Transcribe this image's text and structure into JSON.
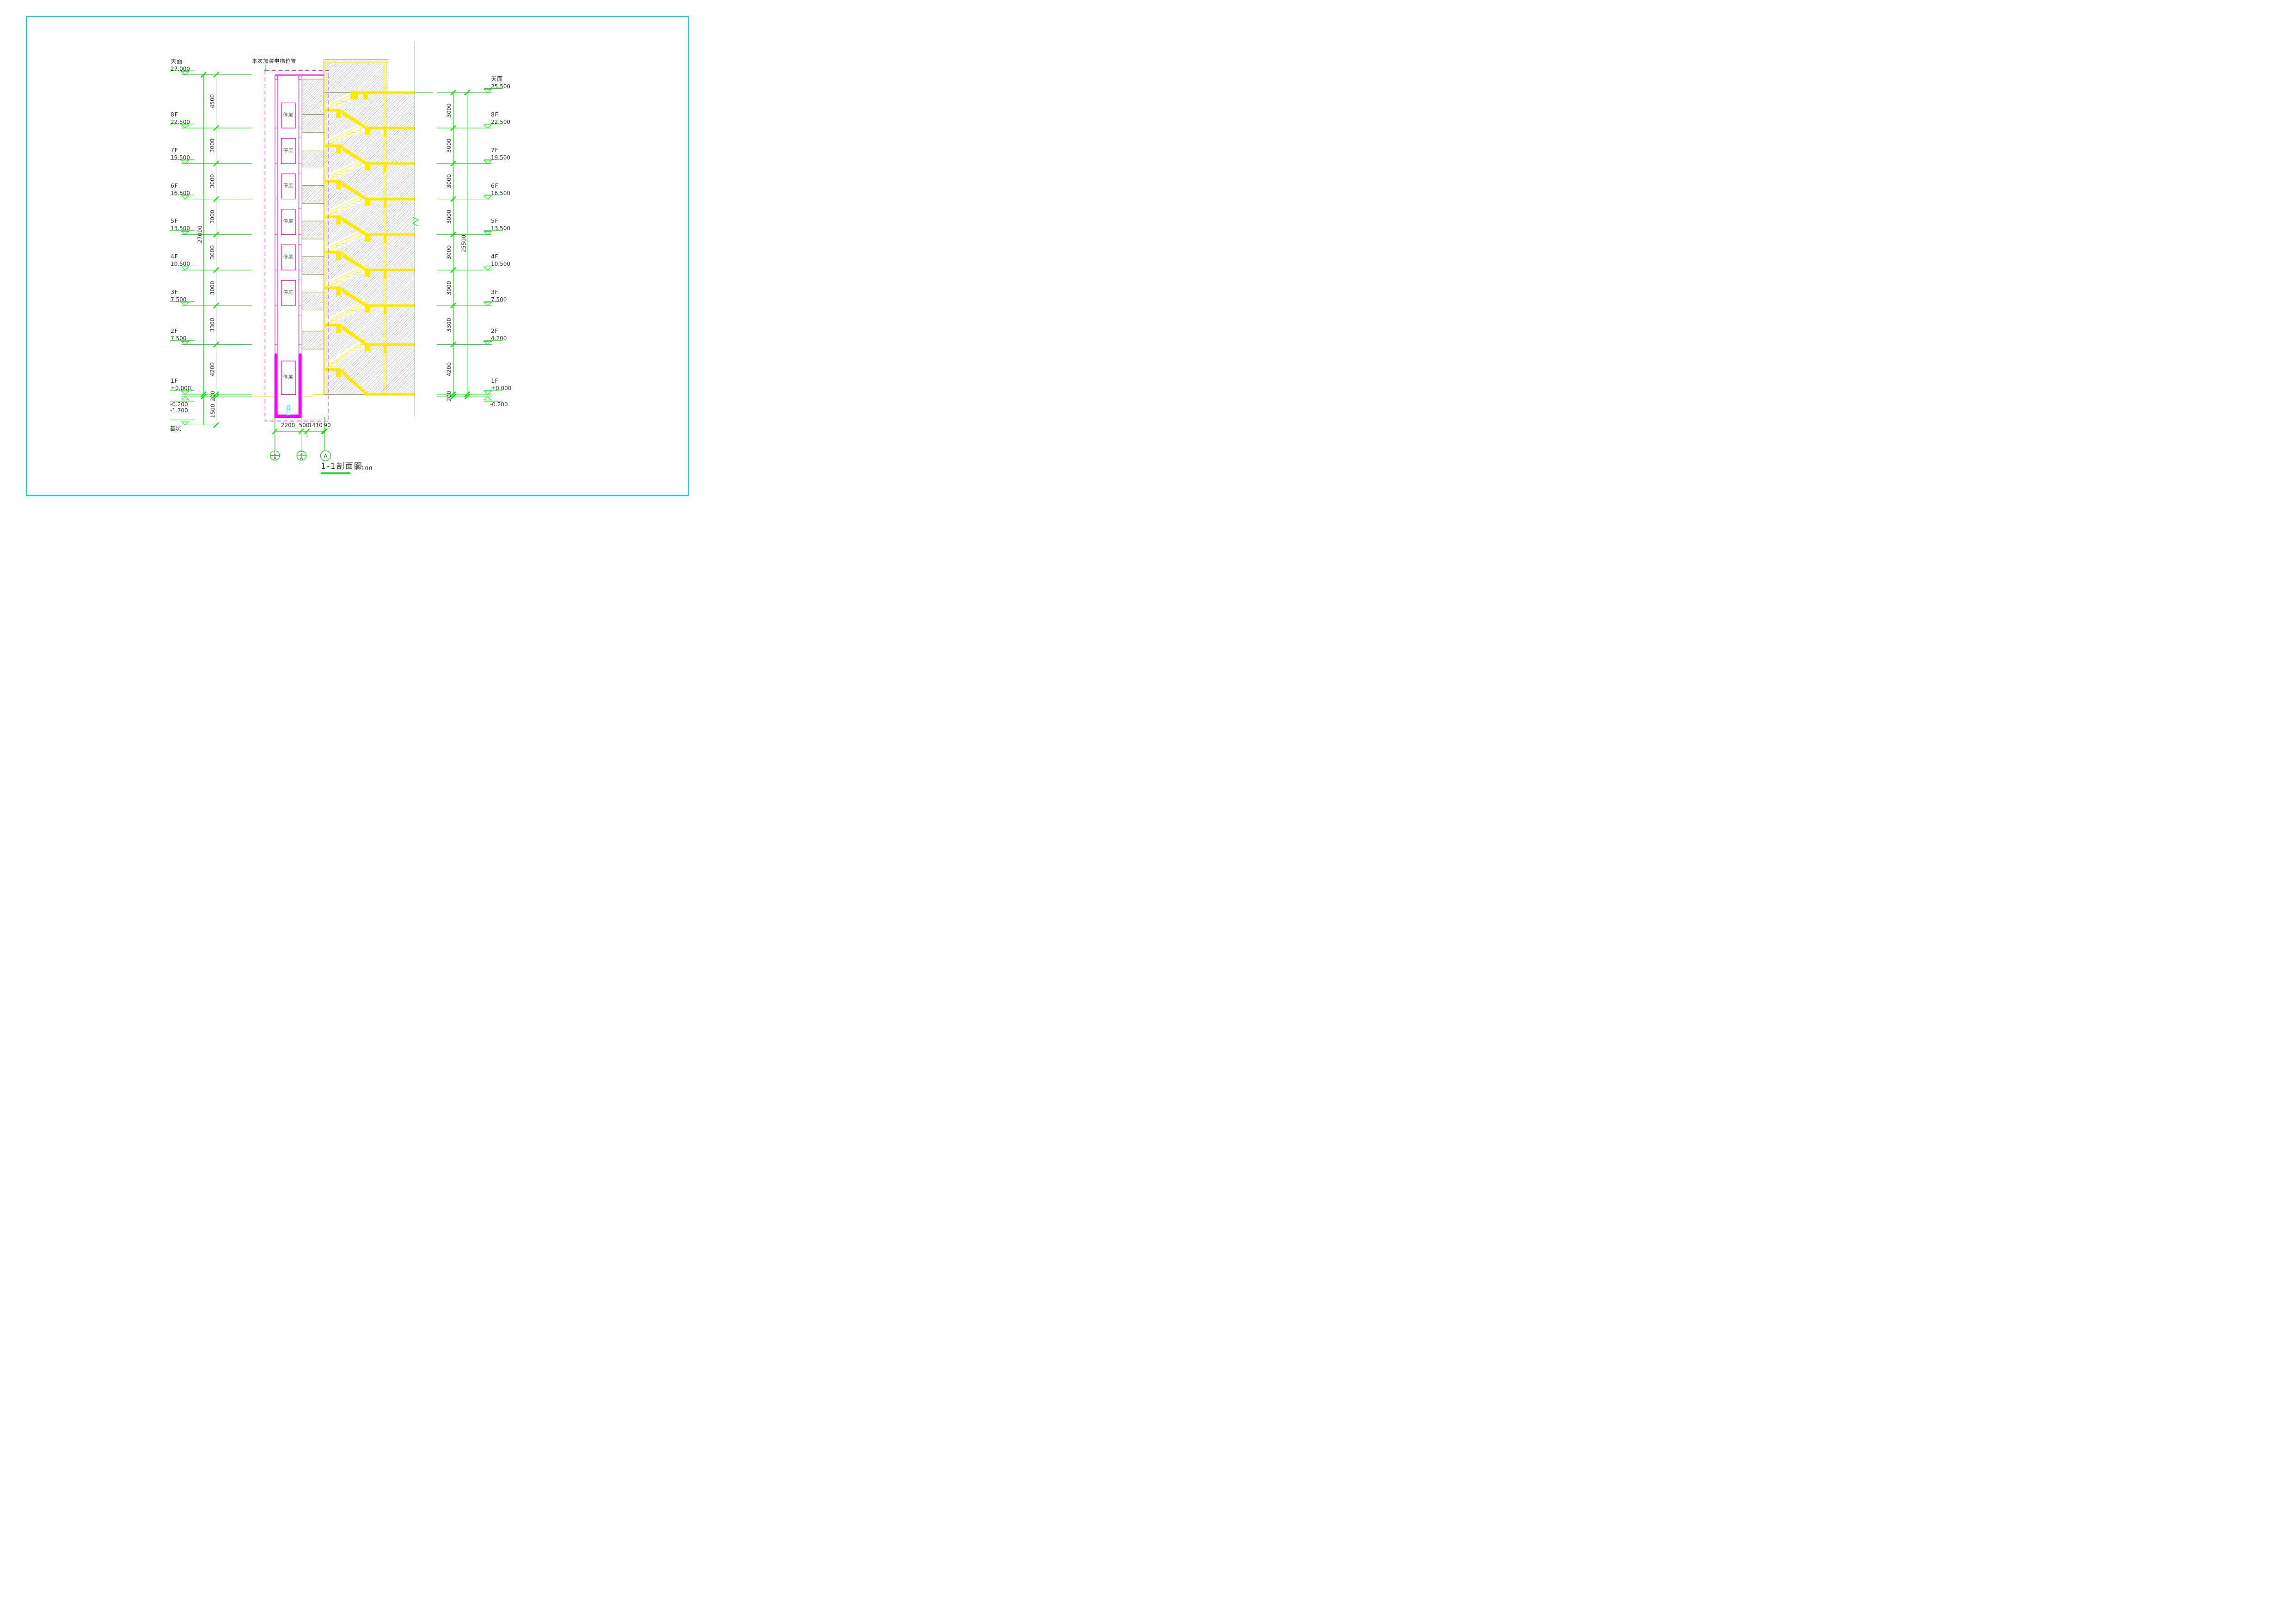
{
  "annotation": {
    "label": "本次加装电梯位置"
  },
  "left_column": {
    "levels": [
      {
        "label": "天面",
        "elev": "27.000",
        "pos": 27.0
      },
      {
        "label": "8F",
        "elev": "22.500",
        "pos": 22.5
      },
      {
        "label": "7F",
        "elev": "19.500",
        "pos": 19.5
      },
      {
        "label": "6F",
        "elev": "16.500",
        "pos": 16.5
      },
      {
        "label": "5F",
        "elev": "13.500",
        "pos": 13.5
      },
      {
        "label": "4F",
        "elev": "10.500",
        "pos": 10.5
      },
      {
        "label": "3F",
        "elev": "7.500",
        "pos": 7.5
      },
      {
        "label": "2F",
        "elev": "7.500",
        "pos": 4.2
      },
      {
        "label": "1F",
        "elev": "±0.000",
        "pos": 0.0
      }
    ],
    "gap_dims": [
      "4500",
      "3000",
      "3000",
      "3000",
      "3000",
      "3000",
      "3300",
      "4200"
    ],
    "overall_dim": "27000",
    "below": {
      "l1": "-0.200",
      "l2": "-1.700",
      "pit": "基坑",
      "d1": "200",
      "d2": "1500"
    }
  },
  "right_column": {
    "levels": [
      {
        "label": "天面",
        "elev": "25.500",
        "pos": 25.5
      },
      {
        "label": "8F",
        "elev": "22.500",
        "pos": 22.5
      },
      {
        "label": "7F",
        "elev": "19.500",
        "pos": 19.5
      },
      {
        "label": "6F",
        "elev": "16.500",
        "pos": 16.5
      },
      {
        "label": "5F",
        "elev": "13.500",
        "pos": 13.5
      },
      {
        "label": "4F",
        "elev": "10.500",
        "pos": 10.5
      },
      {
        "label": "3F",
        "elev": "7.500",
        "pos": 7.5
      },
      {
        "label": "2F",
        "elev": "4.200",
        "pos": 4.2
      },
      {
        "label": "1F",
        "elev": "±0.000",
        "pos": 0.0
      }
    ],
    "gap_dims": [
      "3000",
      "3000",
      "3000",
      "3000",
      "3000",
      "3000",
      "3300",
      "4200"
    ],
    "overall_dim": "25500",
    "below": {
      "l1": "-0.200",
      "d1": "200"
    }
  },
  "shaft": {
    "stop_label": "停层",
    "stops_pos": [
      22.5,
      19.5,
      16.5,
      13.5,
      10.5,
      7.5
    ]
  },
  "stairs": {
    "floors_pos": [
      25.5,
      22.5,
      19.5,
      16.5,
      13.5,
      10.5,
      7.5,
      4.2,
      0.0
    ]
  },
  "bottom": {
    "dims": [
      "2200",
      "500",
      "1410",
      "90"
    ],
    "bubbles": [
      {
        "top": "1",
        "bot": "A"
      },
      {
        "top": "2",
        "bot": "A"
      },
      {
        "single": "A"
      }
    ]
  },
  "title": {
    "text": "1-1剖面图",
    "scale": "1:100"
  },
  "colors": {
    "green": "#00e400",
    "dark_green": "#2f9e2f",
    "magenta": "#ff00ff",
    "box_pink": "#ff00c8",
    "yellow": "#ffe900",
    "cyan": "#00ffff",
    "hatch_border": "#8f8f4a",
    "hatch_line": "#9b9b9b",
    "frame": "#00dcdc",
    "text": "#333333"
  }
}
